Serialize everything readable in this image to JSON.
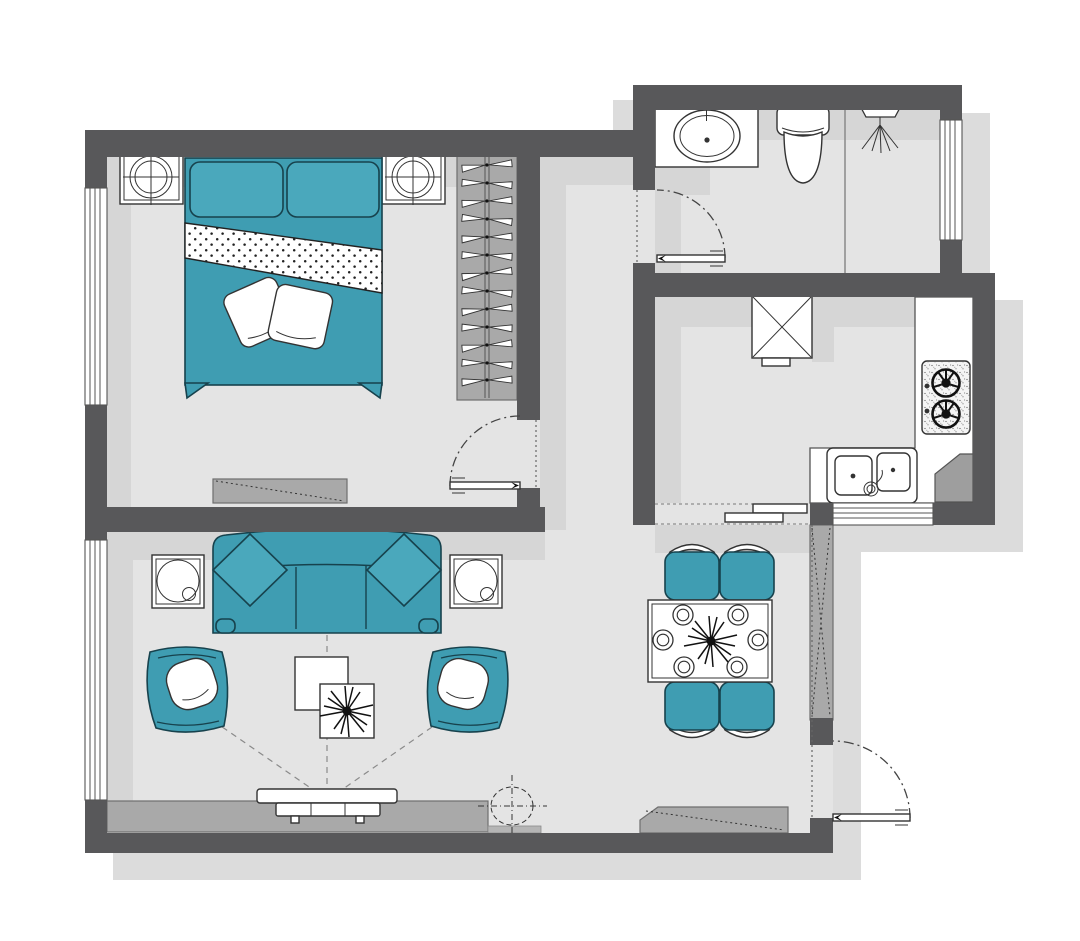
{
  "title": "Apartment Floor Plan",
  "colors": {
    "paper": "#ffffff",
    "wall": "#58585a",
    "floor": "#e4e4e4",
    "shin": "#d6d6d6",
    "shout": "#dcdcdc",
    "teal": "#3f9db2",
    "teal2": "#4aa8bc",
    "tealdark": "#17424d",
    "gray": "#a9a9a9",
    "graydark": "#6e6e6e",
    "ink": "#333333"
  },
  "plan": {
    "rooms": [
      {
        "name": "bedroom",
        "furniture": [
          "double-bed",
          "bolster-pillows",
          "duvet-fold-band",
          "two-white-pillows",
          "nightstand-left",
          "nightstand-right",
          "two-table-lamps",
          "wardrobe-with-hangers",
          "dresser"
        ]
      },
      {
        "name": "bathroom",
        "furniture": [
          "vanity-counter",
          "oval-sink",
          "toilet",
          "shower-head",
          "glass-divider"
        ]
      },
      {
        "name": "kitchen",
        "furniture": [
          "refrigerator",
          "l-shaped-counter",
          "gas-stove-two-burner",
          "double-basin-sink",
          "corner-board"
        ]
      },
      {
        "name": "living-room",
        "furniture": [
          "three-seat-sofa",
          "two-diamond-cushions",
          "armchair-left",
          "armchair-right",
          "side-table-left",
          "side-table-right",
          "two-coffee-tables",
          "starburst-decor",
          "tv",
          "tv-console",
          "viewing-sight-lines"
        ]
      },
      {
        "name": "dining-area",
        "furniture": [
          "dining-table",
          "four-chairs",
          "six-place-settings",
          "starburst-centerpiece"
        ]
      },
      {
        "name": "entry",
        "furniture": [
          "tall-cabinet",
          "shoe-cabinet",
          "floor-symbol-crosshair"
        ]
      }
    ],
    "windows": [
      "bedroom-west",
      "living-west",
      "bathroom-east",
      "kitchen-south"
    ],
    "doors": [
      "bedroom-door",
      "bathroom-door",
      "entrance-door"
    ],
    "openings": [
      "kitchen-passage"
    ]
  }
}
